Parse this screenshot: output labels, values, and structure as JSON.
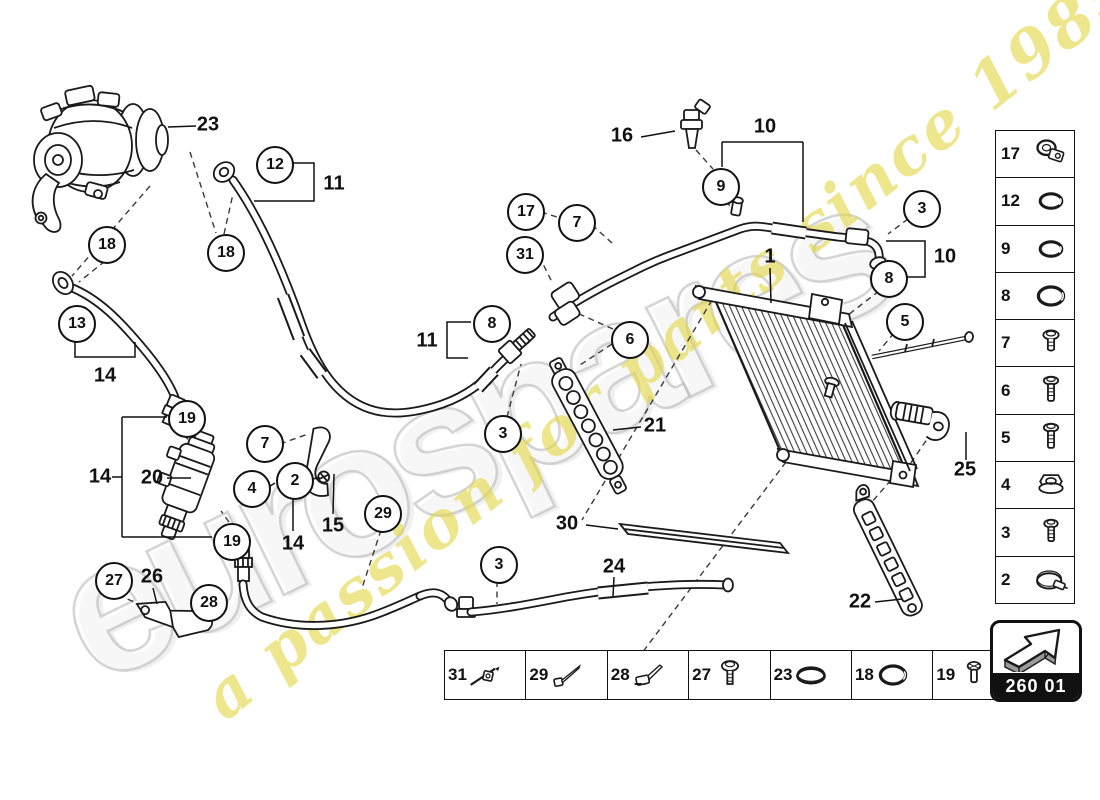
{
  "watermark": {
    "brand": "eurospares",
    "tagline": "a passion for parts since 1985",
    "brand_outline_color": "#bdbdbd",
    "tagline_color": "#e4d746"
  },
  "badge": {
    "code": "260 01"
  },
  "callouts": [
    {
      "n": "12",
      "x": 273,
      "y": 163
    },
    {
      "n": "18",
      "x": 105,
      "y": 243
    },
    {
      "n": "18",
      "x": 224,
      "y": 251
    },
    {
      "n": "13",
      "x": 75,
      "y": 322
    },
    {
      "n": "19",
      "x": 185,
      "y": 417
    },
    {
      "n": "7",
      "x": 263,
      "y": 442
    },
    {
      "n": "4",
      "x": 250,
      "y": 487
    },
    {
      "n": "2",
      "x": 293,
      "y": 479
    },
    {
      "n": "19",
      "x": 230,
      "y": 540
    },
    {
      "n": "27",
      "x": 112,
      "y": 579
    },
    {
      "n": "28",
      "x": 207,
      "y": 601
    },
    {
      "n": "29",
      "x": 381,
      "y": 512
    },
    {
      "n": "3",
      "x": 497,
      "y": 563
    },
    {
      "n": "17",
      "x": 524,
      "y": 210
    },
    {
      "n": "7",
      "x": 575,
      "y": 221
    },
    {
      "n": "31",
      "x": 523,
      "y": 253
    },
    {
      "n": "8",
      "x": 490,
      "y": 322
    },
    {
      "n": "6",
      "x": 628,
      "y": 338
    },
    {
      "n": "3",
      "x": 501,
      "y": 432
    },
    {
      "n": "9",
      "x": 719,
      "y": 185
    },
    {
      "n": "3",
      "x": 920,
      "y": 207
    },
    {
      "n": "8",
      "x": 887,
      "y": 277
    },
    {
      "n": "5",
      "x": 903,
      "y": 320
    }
  ],
  "labels": [
    {
      "t": "23",
      "x": 208,
      "y": 125
    },
    {
      "t": "11",
      "x": 334,
      "y": 184
    },
    {
      "t": "14",
      "x": 105,
      "y": 376
    },
    {
      "t": "14",
      "x": 100,
      "y": 477
    },
    {
      "t": "20",
      "x": 152,
      "y": 478
    },
    {
      "t": "15",
      "x": 333,
      "y": 526
    },
    {
      "t": "14",
      "x": 293,
      "y": 544
    },
    {
      "t": "26",
      "x": 152,
      "y": 577
    },
    {
      "t": "30",
      "x": 567,
      "y": 524
    },
    {
      "t": "24",
      "x": 614,
      "y": 567
    },
    {
      "t": "21",
      "x": 655,
      "y": 426
    },
    {
      "t": "11",
      "x": 427,
      "y": 341
    },
    {
      "t": "16",
      "x": 622,
      "y": 136
    },
    {
      "t": "10",
      "x": 765,
      "y": 127
    },
    {
      "t": "1",
      "x": 770,
      "y": 257
    },
    {
      "t": "10",
      "x": 945,
      "y": 257
    },
    {
      "t": "25",
      "x": 965,
      "y": 470
    },
    {
      "t": "22",
      "x": 860,
      "y": 602
    }
  ],
  "right_panel": {
    "items": [
      {
        "n": "17",
        "icon": "clamp-bracket"
      },
      {
        "n": "12",
        "icon": "o-ring"
      },
      {
        "n": "9",
        "icon": "o-ring"
      },
      {
        "n": "8",
        "icon": "o-ring-large"
      },
      {
        "n": "7",
        "icon": "screw-short"
      },
      {
        "n": "6",
        "icon": "screw-long"
      },
      {
        "n": "5",
        "icon": "screw-long"
      },
      {
        "n": "4",
        "icon": "flange-nut"
      },
      {
        "n": "3",
        "icon": "screw-medium"
      },
      {
        "n": "2",
        "icon": "hose-clamp"
      }
    ]
  },
  "bottom_panel": {
    "items": [
      {
        "n": "31",
        "icon": "cable-tie-anchor"
      },
      {
        "n": "29",
        "icon": "cable-tie"
      },
      {
        "n": "28",
        "icon": "clip-tie"
      },
      {
        "n": "27",
        "icon": "screw-washer"
      },
      {
        "n": "23",
        "icon": "o-ring-flat"
      },
      {
        "n": "18",
        "icon": "o-ring-large"
      },
      {
        "n": "19",
        "icon": "bolt-small"
      }
    ]
  }
}
